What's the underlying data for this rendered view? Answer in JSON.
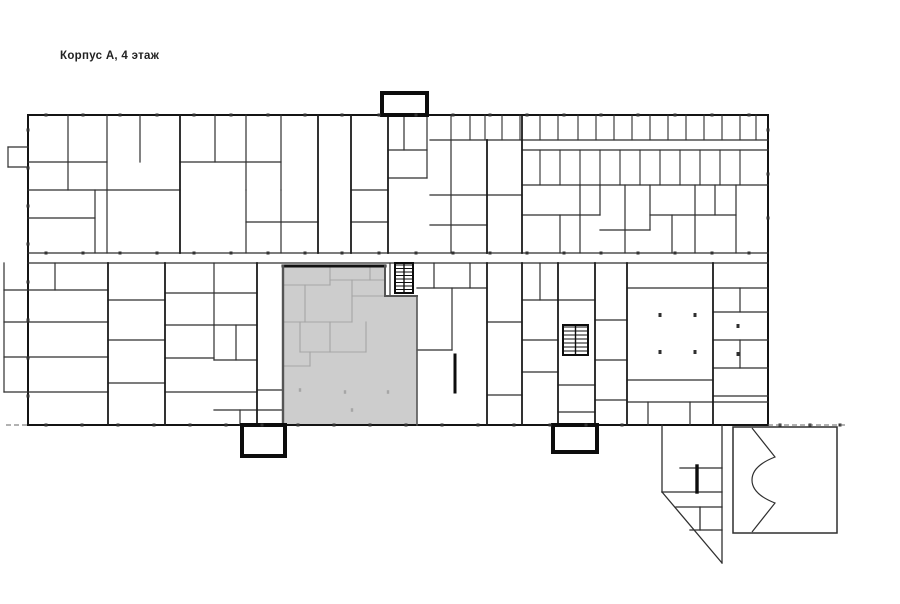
{
  "title": {
    "text": "Корпус А, 4 этаж"
  },
  "canvas": {
    "width": 900,
    "height": 604,
    "background": "#ffffff"
  },
  "colors": {
    "wall": "#2f2f2f",
    "wall_medium": "#1c1c1c",
    "wall_thick": "#0d0d0d",
    "outer": "#141414",
    "faint": "#a6a6a6",
    "highlight_fill": "#cdcdcd",
    "highlight_edge": "#555555",
    "highlight_top_edge": "#111111",
    "tick": "#333333",
    "dash": "#666666"
  },
  "floorplan": {
    "outer_path": "M28,115 L382,115 L382,93 L427,93 L427,115 L768,115 L768,425 L28,425 Z",
    "highlight": {
      "polygon": "283,266 385,266 385,296 417,296 417,425 283,425",
      "border_lines": [
        {
          "pts": [
            283,
            266,
            385,
            266
          ],
          "w": 3
        },
        {
          "pts": [
            283,
            266,
            283,
            425
          ],
          "w": 2.4
        },
        {
          "pts": [
            385,
            266,
            385,
            296
          ],
          "w": 2
        },
        {
          "pts": [
            385,
            296,
            417,
            296
          ],
          "w": 2
        },
        {
          "pts": [
            417,
            296,
            417,
            425
          ],
          "w": 1.6
        }
      ]
    },
    "walls_medium": [
      [
        180,
        115,
        180,
        253
      ],
      [
        318,
        115,
        318,
        253
      ],
      [
        351,
        115,
        351,
        253
      ],
      [
        388,
        115,
        388,
        253
      ],
      [
        522,
        115,
        522,
        253
      ],
      [
        487,
        140,
        487,
        253
      ],
      [
        108,
        263,
        108,
        425
      ],
      [
        165,
        263,
        165,
        425
      ],
      [
        257,
        263,
        257,
        425
      ],
      [
        487,
        263,
        487,
        425
      ],
      [
        522,
        263,
        522,
        425
      ],
      [
        558,
        263,
        558,
        425
      ],
      [
        595,
        263,
        595,
        425
      ],
      [
        627,
        263,
        627,
        425
      ],
      [
        713,
        263,
        713,
        425
      ]
    ],
    "walls_thin": [
      [
        68,
        115,
        68,
        190
      ],
      [
        107,
        115,
        107,
        253
      ],
      [
        140,
        115,
        140,
        162
      ],
      [
        28,
        162,
        107,
        162
      ],
      [
        28,
        190,
        180,
        190
      ],
      [
        28,
        218,
        95,
        218
      ],
      [
        95,
        190,
        95,
        253
      ],
      [
        215,
        115,
        215,
        162
      ],
      [
        246,
        115,
        246,
        190
      ],
      [
        281,
        115,
        281,
        190
      ],
      [
        180,
        162,
        281,
        162
      ],
      [
        246,
        190,
        246,
        253
      ],
      [
        281,
        190,
        281,
        253
      ],
      [
        246,
        222,
        318,
        222
      ],
      [
        351,
        190,
        388,
        190
      ],
      [
        351,
        222,
        388,
        222
      ],
      [
        404,
        115,
        404,
        150
      ],
      [
        388,
        150,
        427,
        150
      ],
      [
        388,
        178,
        427,
        178
      ],
      [
        427,
        115,
        427,
        178
      ],
      [
        430,
        140,
        768,
        140
      ],
      [
        522,
        150,
        768,
        150
      ],
      [
        522,
        185,
        768,
        185
      ],
      [
        451,
        140,
        451,
        253
      ],
      [
        430,
        195,
        522,
        195
      ],
      [
        430,
        225,
        487,
        225
      ],
      [
        560,
        215,
        560,
        253
      ],
      [
        580,
        185,
        580,
        253
      ],
      [
        600,
        185,
        600,
        215
      ],
      [
        625,
        185,
        625,
        253
      ],
      [
        650,
        185,
        650,
        230
      ],
      [
        672,
        215,
        672,
        253
      ],
      [
        695,
        185,
        695,
        253
      ],
      [
        715,
        185,
        715,
        215
      ],
      [
        736,
        185,
        736,
        253
      ],
      [
        522,
        215,
        600,
        215
      ],
      [
        650,
        215,
        736,
        215
      ],
      [
        600,
        230,
        650,
        230
      ],
      [
        28,
        253,
        768,
        253
      ],
      [
        28,
        263,
        768,
        263
      ],
      [
        55,
        263,
        55,
        290
      ],
      [
        28,
        290,
        108,
        290
      ],
      [
        28,
        322,
        108,
        322
      ],
      [
        28,
        357,
        108,
        357
      ],
      [
        28,
        392,
        108,
        392
      ],
      [
        108,
        300,
        165,
        300
      ],
      [
        108,
        340,
        165,
        340
      ],
      [
        108,
        383,
        165,
        383
      ],
      [
        214,
        263,
        214,
        360
      ],
      [
        165,
        293,
        257,
        293
      ],
      [
        165,
        325,
        214,
        325
      ],
      [
        165,
        358,
        214,
        358
      ],
      [
        165,
        392,
        257,
        392
      ],
      [
        214,
        325,
        257,
        325
      ],
      [
        214,
        360,
        257,
        360
      ],
      [
        236,
        325,
        236,
        360
      ],
      [
        214,
        410,
        283,
        410
      ],
      [
        240,
        410,
        240,
        425
      ],
      [
        257,
        390,
        283,
        390
      ],
      [
        4,
        263,
        4,
        392
      ],
      [
        4,
        290,
        28,
        290
      ],
      [
        4,
        322,
        28,
        322
      ],
      [
        4,
        357,
        28,
        357
      ],
      [
        4,
        392,
        28,
        392
      ],
      [
        8,
        147,
        8,
        167
      ],
      [
        8,
        147,
        28,
        147
      ],
      [
        8,
        167,
        28,
        167
      ],
      [
        390,
        263,
        390,
        296
      ],
      [
        417,
        288,
        487,
        288
      ],
      [
        434,
        263,
        434,
        288
      ],
      [
        452,
        288,
        452,
        350
      ],
      [
        417,
        350,
        452,
        350
      ],
      [
        470,
        263,
        470,
        288
      ],
      [
        487,
        322,
        522,
        322
      ],
      [
        487,
        395,
        522,
        395
      ],
      [
        522,
        300,
        558,
        300
      ],
      [
        540,
        263,
        540,
        300
      ],
      [
        522,
        340,
        558,
        340
      ],
      [
        522,
        372,
        558,
        372
      ],
      [
        558,
        300,
        595,
        300
      ],
      [
        558,
        385,
        595,
        385
      ],
      [
        558,
        412,
        595,
        412
      ],
      [
        595,
        320,
        627,
        320
      ],
      [
        595,
        360,
        627,
        360
      ],
      [
        595,
        400,
        627,
        400
      ],
      [
        627,
        288,
        713,
        288
      ],
      [
        627,
        380,
        713,
        380
      ],
      [
        627,
        402,
        768,
        402
      ],
      [
        648,
        402,
        648,
        425
      ],
      [
        690,
        402,
        690,
        425
      ],
      [
        713,
        288,
        768,
        288
      ],
      [
        713,
        312,
        768,
        312
      ],
      [
        713,
        340,
        768,
        340
      ],
      [
        713,
        368,
        768,
        368
      ],
      [
        713,
        396,
        768,
        396
      ],
      [
        740,
        288,
        740,
        312
      ],
      [
        740,
        340,
        740,
        368
      ],
      [
        389,
        108,
        420,
        108
      ],
      [
        248,
        446,
        280,
        446
      ],
      [
        560,
        444,
        590,
        444
      ]
    ],
    "wall_stubs_thick": [
      [
        455,
        355,
        455,
        392
      ]
    ],
    "top_room_dividers": {
      "y1": 115,
      "y2": 140,
      "xs": [
        451,
        470,
        485,
        502,
        520,
        540,
        558,
        578,
        596,
        614,
        632,
        650,
        668,
        686,
        704,
        722,
        740,
        756
      ]
    },
    "band2_dividers": {
      "y1": 150,
      "y2": 185,
      "xs": [
        540,
        560,
        580,
        600,
        620,
        640,
        660,
        680,
        700,
        720,
        740
      ]
    },
    "stair_rects": [
      {
        "x": 382,
        "y": 93,
        "w": 45,
        "h": 22
      },
      {
        "x": 242,
        "y": 425,
        "w": 43,
        "h": 31
      },
      {
        "x": 553,
        "y": 425,
        "w": 44,
        "h": 27
      }
    ],
    "stair_hatch_boxes": [
      {
        "x": 395,
        "y": 263,
        "w": 18,
        "h": 30,
        "step": 3.5
      },
      {
        "x": 563,
        "y": 325,
        "w": 25,
        "h": 30,
        "step": 4
      }
    ],
    "annex": {
      "lines": [
        [
          662,
          425,
          662,
          492
        ],
        [
          662,
          492,
          722,
          563
        ],
        [
          722,
          425,
          722,
          563
        ],
        [
          680,
          468,
          722,
          468
        ],
        [
          662,
          492,
          722,
          492
        ],
        [
          676,
          507,
          722,
          507
        ],
        [
          690,
          530,
          722,
          530
        ],
        [
          700,
          507,
          700,
          530
        ]
      ],
      "thick_lines": [
        [
          697,
          466,
          697,
          492
        ]
      ],
      "hall_rect": {
        "x": 733,
        "y": 427,
        "w": 104,
        "h": 106
      },
      "notch_path": "M752,428 L775,457 C757,464 752,472 752,480 C752,488 757,496 775,503 L752,532"
    },
    "faint_lines": [
      [
        283,
        285,
        330,
        285
      ],
      [
        305,
        285,
        305,
        322
      ],
      [
        330,
        266,
        330,
        285
      ],
      [
        330,
        280,
        385,
        280
      ],
      [
        370,
        266,
        370,
        280
      ],
      [
        352,
        280,
        352,
        322
      ],
      [
        283,
        322,
        352,
        322
      ],
      [
        330,
        322,
        330,
        352
      ],
      [
        366,
        322,
        366,
        352
      ],
      [
        300,
        322,
        300,
        352
      ],
      [
        300,
        352,
        366,
        352
      ],
      [
        310,
        352,
        310,
        366
      ],
      [
        283,
        366,
        310,
        366
      ],
      [
        352,
        296,
        385,
        296
      ]
    ],
    "faint_dots": [
      [
        345,
        392
      ],
      [
        388,
        392
      ],
      [
        352,
        410
      ],
      [
        300,
        390
      ]
    ],
    "column_dots": [
      [
        660,
        315
      ],
      [
        695,
        315
      ],
      [
        660,
        352
      ],
      [
        695,
        352
      ],
      [
        738,
        326
      ],
      [
        738,
        354
      ]
    ],
    "ticks": [
      {
        "axis": "x",
        "y": 115,
        "x1": 46,
        "x2": 760,
        "step": 37
      },
      {
        "axis": "x",
        "y": 253,
        "x1": 46,
        "x2": 760,
        "step": 37
      },
      {
        "axis": "x",
        "y": 425,
        "x1": 46,
        "x2": 648,
        "step": 36
      },
      {
        "axis": "x",
        "y": 425,
        "x1": 780,
        "x2": 842,
        "step": 30
      },
      {
        "axis": "y",
        "x": 28,
        "y1": 130,
        "y2": 410,
        "step": 38
      },
      {
        "axis": "y",
        "x": 768,
        "y1": 130,
        "y2": 250,
        "step": 44
      }
    ],
    "dashed_lines": [
      [
        768,
        425,
        847,
        425
      ],
      [
        6,
        425,
        28,
        425
      ]
    ]
  }
}
